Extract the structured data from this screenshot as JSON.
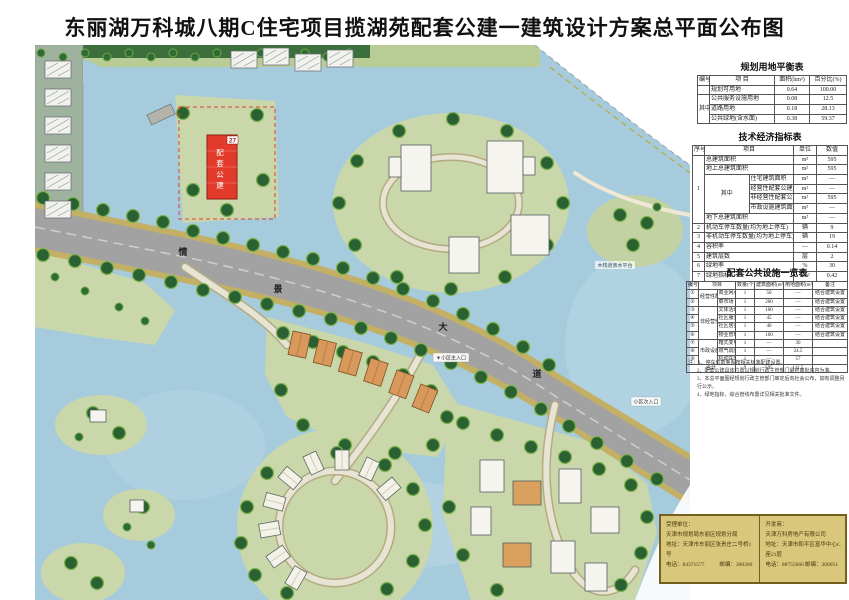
{
  "page_title": "东丽湖万科城八期C住宅项目揽湖苑配套公建一建筑设计方案总平面公布图",
  "map": {
    "plot_label": "27",
    "plot_building_chars": [
      "配",
      "套",
      "公",
      "建"
    ],
    "road_chars": [
      "情",
      "景",
      "大",
      "道"
    ],
    "labels": {
      "boardwalk": "木栈道亲水平台",
      "main_entry": "▼小区主入口",
      "side_entry": "小区次入口"
    }
  },
  "land_table": {
    "title": "规划用地平衡表",
    "headers": [
      "编号",
      "项  目",
      "面积(hm²)",
      "百分比(%)"
    ],
    "zhong": "其中",
    "rows": [
      {
        "name": "规划可用地",
        "area": "0.64",
        "pct": "100.00"
      },
      {
        "name": "公共服务设施用地",
        "area": "0.08",
        "pct": "12.5"
      },
      {
        "name": "道路用地",
        "area": "0.18",
        "pct": "28.13"
      },
      {
        "name": "公共绿地(含水面)",
        "area": "0.38",
        "pct": "59.37"
      }
    ]
  },
  "tech_table": {
    "title": "技术经济指标表",
    "headers": [
      "序号",
      "项目",
      "单位",
      "数值"
    ],
    "zhong": "其中",
    "rows": [
      {
        "no": "1",
        "name": "总建筑面积",
        "unit": "m²",
        "val": "595"
      },
      {
        "no": "",
        "name": "地上总建筑面积",
        "unit": "m²",
        "val": "595"
      },
      {
        "no": "",
        "name": "住宅建筑面积",
        "unit": "m²",
        "val": "—"
      },
      {
        "no": "",
        "name": "经营性配套公建建筑面积",
        "unit": "m²",
        "val": "—"
      },
      {
        "no": "",
        "name": "非经营性配套公建建筑面积",
        "unit": "m²",
        "val": "595"
      },
      {
        "no": "",
        "name": "市政设施建筑面积",
        "unit": "m²",
        "val": "—"
      },
      {
        "no": "",
        "name": "地下总建筑面积",
        "unit": "m²",
        "val": "—"
      },
      {
        "no": "2",
        "name": "机动车停车数量(均为地上停车)",
        "unit": "辆",
        "val": "9"
      },
      {
        "no": "3",
        "name": "非机动车停车数量(均为地上停车)",
        "unit": "辆",
        "val": "19"
      },
      {
        "no": "4",
        "name": "容积率",
        "unit": "—",
        "val": "0.14"
      },
      {
        "no": "5",
        "name": "建筑层数",
        "unit": "层",
        "val": "2"
      },
      {
        "no": "6",
        "name": "绿地率",
        "unit": "%",
        "val": "30"
      },
      {
        "no": "7",
        "name": "绿地指标",
        "unit": "hm²",
        "val": "0.42"
      }
    ]
  },
  "fac_table": {
    "title": "配套公共设施一览表",
    "headers": [
      "编号",
      "项目",
      "数量(个)",
      "建筑面积(m²)",
      "用地面积(m²)",
      "备注"
    ],
    "groups": [
      "经营性配套公建",
      "非经营性配套公建",
      "市政设施"
    ],
    "rows": [
      {
        "no": "①",
        "name": "商业网点",
        "qty": "1",
        "barea": "50",
        "larea": "—",
        "note": "结合建筑设置"
      },
      {
        "no": "②",
        "name": "菜市场",
        "qty": "1",
        "barea": "200",
        "larea": "—",
        "note": "结合建筑设置"
      },
      {
        "no": "③",
        "name": "文体活动站",
        "qty": "1",
        "barea": "100",
        "larea": "—",
        "note": "结合建筑设置"
      },
      {
        "no": "④",
        "name": "社区服务站",
        "qty": "1",
        "barea": "45",
        "larea": "—",
        "note": "结合建筑设置"
      },
      {
        "no": "⑤",
        "name": "社区居委会",
        "qty": "1",
        "barea": "40",
        "larea": "—",
        "note": "结合建筑设置"
      },
      {
        "no": "⑥",
        "name": "物业管理用房",
        "qty": "1",
        "barea": "160",
        "larea": "—",
        "note": "结合建筑设置"
      },
      {
        "no": "⑦",
        "name": "箱式变电站",
        "qty": "1",
        "barea": "—",
        "larea": "30",
        "note": ""
      },
      {
        "no": "⑧",
        "name": "燃气调压站",
        "qty": "1",
        "barea": "—",
        "larea": "24.5",
        "note": ""
      },
      {
        "no": "⑨",
        "name": "机动车停车场",
        "qty": "1",
        "barea": "—",
        "larea": "57",
        "note": ""
      }
    ],
    "total": {
      "label": "合计",
      "qty": "9",
      "barea": "595",
      "larea": "111.5"
    },
    "notes": [
      "注：1、停车位数量系按相关标准配建设置。",
      "2、配套公建具体位置以规划行政主管部门最终审批内容为准。",
      "3、本总平面图经规划行政主管部门审定后向社会公布，如有调整另行公示。",
      "4、绿地指标、综合管线布置详见相关批准文件。"
    ]
  },
  "stamp": {
    "left": {
      "role": "受理单位：",
      "name": "天津市规划局东丽区规划分局",
      "addr": "地址：天津市东丽区张贵庄二号桥1号",
      "tel": "电话：84371577",
      "zip": "邮编：300300"
    },
    "right": {
      "role": "开发商：",
      "name": "天津万科房地产有限公司",
      "addr": "地址：天津市和平区富华中心C座21层",
      "tel": "电话：88755666",
      "zip": "邮编：300051"
    }
  }
}
